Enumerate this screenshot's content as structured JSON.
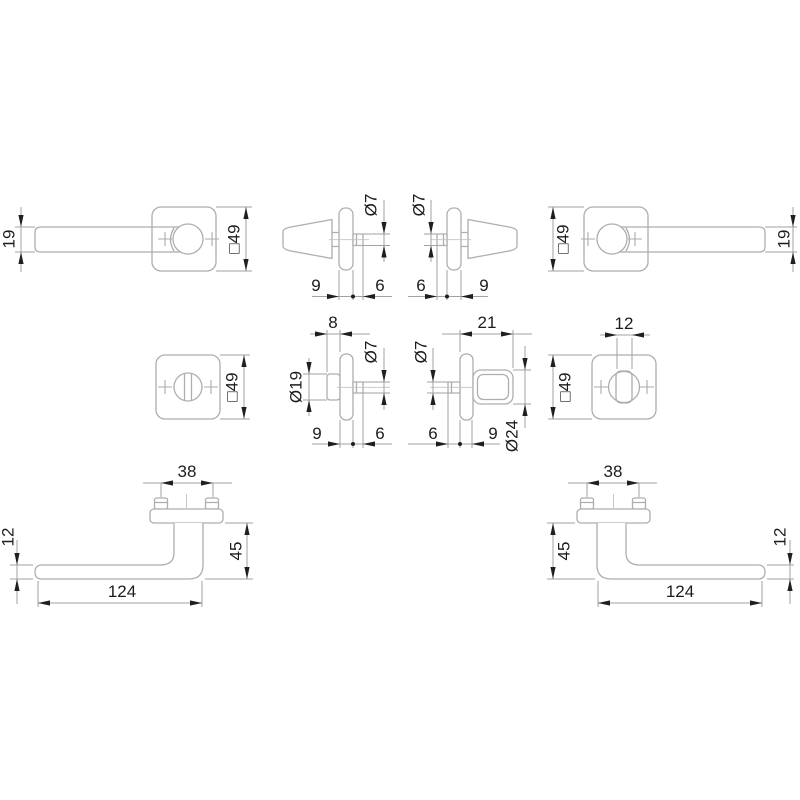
{
  "views": {
    "a": {
      "lever_width": "19",
      "rose_size": "□49"
    },
    "b": {
      "spindle_dia": "Ø7",
      "rose_depth": "9",
      "spindle_out": "6"
    },
    "c": {
      "spindle_dia": "Ø7",
      "spindle_out": "6",
      "rose_depth": "9"
    },
    "d": {
      "rose_size": "□49",
      "lever_width": "19"
    },
    "e": {
      "rose_size": "□49"
    },
    "f": {
      "release_out": "8",
      "release_dia": "Ø19",
      "spindle_dia": "Ø7",
      "rose_depth": "9",
      "spindle_out": "6"
    },
    "g": {
      "turn_out": "21",
      "spindle_dia": "Ø7",
      "turn_dia": "Ø24",
      "spindle_out": "6",
      "rose_depth": "9"
    },
    "h": {
      "turn_width": "12",
      "rose_size": "□49"
    },
    "i": {
      "screw_spacing": "38",
      "lever_height": "12",
      "projection": "45",
      "length": "124"
    },
    "j": {
      "screw_spacing": "38",
      "projection": "45",
      "lever_height": "12",
      "length": "124"
    }
  },
  "colors": {
    "outline": "#aeaeae",
    "dimension": "#a2a2a2",
    "ink": "#1f1f1f",
    "background": "#ffffff"
  }
}
